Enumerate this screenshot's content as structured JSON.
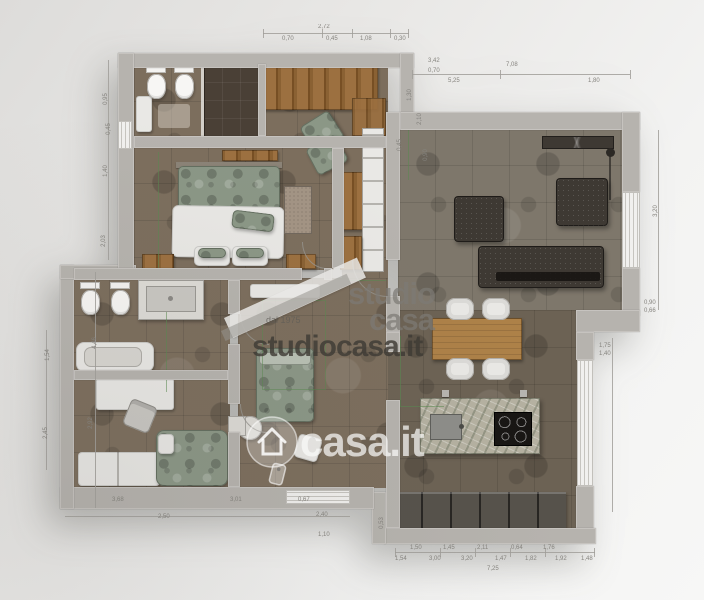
{
  "watermarks": {
    "studio_line1": "studio",
    "studio_line2": "casa",
    "tagline": "dal 1975",
    "site": "studiocasa.it",
    "portal": "casa.it"
  },
  "palette": {
    "background": "#ecebe9",
    "wall": "#b6b3ae",
    "floor_warm": "#7c6e5d",
    "floor_cool": "#7e776b",
    "floor_dark": "#6c6254",
    "wood": "#8a6133",
    "oak": "#ad8148",
    "sage": "#8b9786",
    "charcoal": "#3e3933",
    "white_furniture": "#e9e8e5",
    "cabinet": "#56524b",
    "marble": "#b5b1a1",
    "green_annotation": "#5a8a50",
    "dimension_text": "#85837e",
    "watermark_gray": "#8c8984",
    "watermark_dark": "#3e3a35",
    "watermark_white": "#fafaf8"
  },
  "dimensions": [
    {
      "t": "2,72",
      "x": 318,
      "y": 24,
      "r": 0
    },
    {
      "t": "0,70",
      "x": 282,
      "y": 36,
      "r": 0
    },
    {
      "t": "0,45",
      "x": 326,
      "y": 36,
      "r": 0
    },
    {
      "t": "1,08",
      "x": 360,
      "y": 36,
      "r": 0
    },
    {
      "t": "0,30",
      "x": 394,
      "y": 36,
      "r": 0
    },
    {
      "t": "7,08",
      "x": 506,
      "y": 62,
      "r": 0
    },
    {
      "t": "5,25",
      "x": 448,
      "y": 78,
      "r": 0
    },
    {
      "t": "1,80",
      "x": 588,
      "y": 78,
      "r": 0
    },
    {
      "t": "3,42",
      "x": 428,
      "y": 58,
      "r": 0
    },
    {
      "t": "0,70",
      "x": 428,
      "y": 68,
      "r": 0
    },
    {
      "t": "1,30",
      "x": 404,
      "y": 92,
      "r": -90
    },
    {
      "t": "2,10",
      "x": 414,
      "y": 116,
      "r": -90
    },
    {
      "t": "0,45",
      "x": 394,
      "y": 142,
      "r": -90
    },
    {
      "t": "0,90",
      "x": 420,
      "y": 152,
      "r": -90
    },
    {
      "t": "3,20",
      "x": 650,
      "y": 208,
      "r": -90
    },
    {
      "t": "0,90",
      "x": 644,
      "y": 300,
      "r": 0
    },
    {
      "t": "0,66",
      "x": 644,
      "y": 308,
      "r": 0
    },
    {
      "t": "1,75",
      "x": 599,
      "y": 343,
      "r": 0
    },
    {
      "t": "1,40",
      "x": 599,
      "y": 351,
      "r": 0
    },
    {
      "t": "1,50",
      "x": 410,
      "y": 545,
      "r": 0
    },
    {
      "t": "1,45",
      "x": 443,
      "y": 545,
      "r": 0
    },
    {
      "t": "2,11",
      "x": 477,
      "y": 545,
      "r": 0
    },
    {
      "t": "0,64",
      "x": 511,
      "y": 545,
      "r": 0
    },
    {
      "t": "1,76",
      "x": 543,
      "y": 545,
      "r": 0
    },
    {
      "t": "1,54",
      "x": 395,
      "y": 556,
      "r": 0
    },
    {
      "t": "3,00",
      "x": 429,
      "y": 556,
      "r": 0
    },
    {
      "t": "3,20",
      "x": 461,
      "y": 556,
      "r": 0
    },
    {
      "t": "1,47",
      "x": 495,
      "y": 556,
      "r": 0
    },
    {
      "t": "1,82",
      "x": 525,
      "y": 556,
      "r": 0
    },
    {
      "t": "1,92",
      "x": 555,
      "y": 556,
      "r": 0
    },
    {
      "t": "1,48",
      "x": 581,
      "y": 556,
      "r": 0
    },
    {
      "t": "7,25",
      "x": 487,
      "y": 566,
      "r": 0
    },
    {
      "t": "3,68",
      "x": 112,
      "y": 497,
      "r": 0
    },
    {
      "t": "3,01",
      "x": 230,
      "y": 497,
      "r": 0
    },
    {
      "t": "0,67",
      "x": 298,
      "y": 497,
      "r": 0
    },
    {
      "t": "2,50",
      "x": 158,
      "y": 514,
      "r": 0
    },
    {
      "t": "2,40",
      "x": 316,
      "y": 512,
      "r": 0
    },
    {
      "t": "1,10",
      "x": 318,
      "y": 532,
      "r": 0
    },
    {
      "t": "0,53",
      "x": 376,
      "y": 520,
      "r": -90
    },
    {
      "t": "0,95",
      "x": 100,
      "y": 96,
      "r": -90
    },
    {
      "t": "0,45",
      "x": 103,
      "y": 126,
      "r": -90
    },
    {
      "t": "1,40",
      "x": 100,
      "y": 168,
      "r": -90
    },
    {
      "t": "2,03",
      "x": 98,
      "y": 238,
      "r": -90
    },
    {
      "t": "4,46",
      "x": 89,
      "y": 340,
      "r": -90
    },
    {
      "t": "2,92",
      "x": 85,
      "y": 420,
      "r": -90
    },
    {
      "t": "1,54",
      "x": 42,
      "y": 352,
      "r": -90
    },
    {
      "t": "2,45",
      "x": 40,
      "y": 430,
      "r": -90
    }
  ]
}
